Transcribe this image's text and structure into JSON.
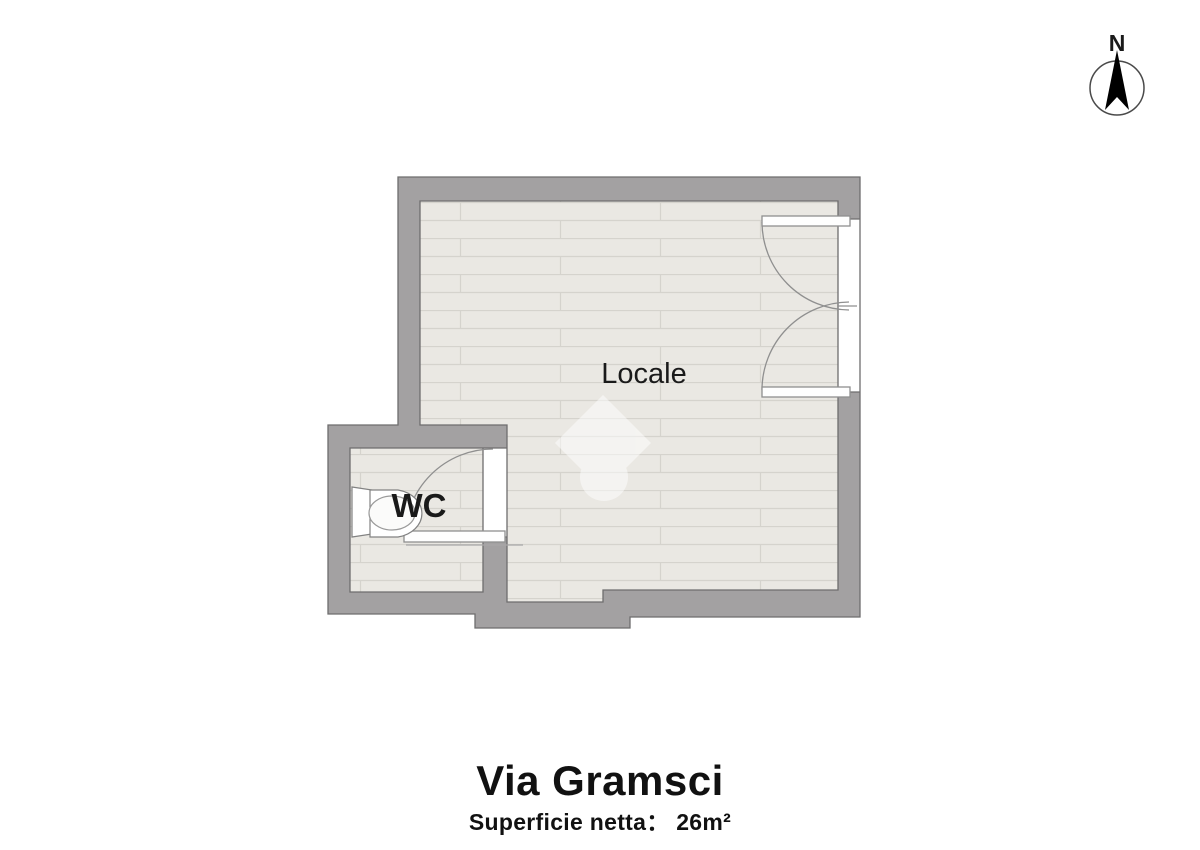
{
  "plan": {
    "room_label": "Locale",
    "wc_label": "WC",
    "compass": {
      "north_label": "N"
    }
  },
  "footer": {
    "title": "Via Gramsci",
    "subtitle": "Superficie netta： 26m²"
  },
  "colors": {
    "wall_fill": "#a3a1a2",
    "wall_outline": "#6e6d6e",
    "floor_fill": "#eae8e3",
    "floor_line": "#d5d3cd",
    "door_line": "#8f8f8f",
    "text": "#1a1a1a"
  }
}
